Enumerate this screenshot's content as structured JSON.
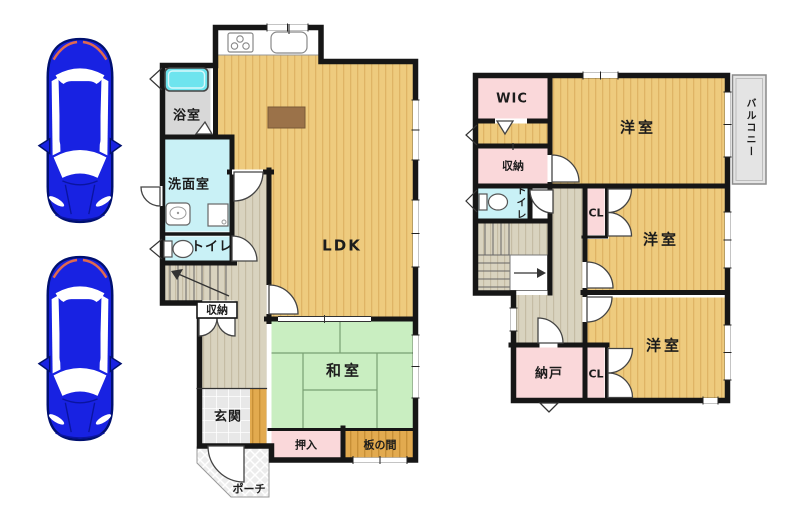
{
  "floor1": {
    "bath": "浴室",
    "washroom": "洗面室",
    "toilet": "トイレ",
    "ldk": "LDK",
    "storage": "収納",
    "genkan": "玄関",
    "washitsu": "和室",
    "oshiire": "押入",
    "itanoma": "板の間",
    "porch": "ポーチ"
  },
  "floor2": {
    "wic": "WIC",
    "bedroom1": "洋室",
    "bedroom2": "洋室",
    "bedroom3": "洋室",
    "storage": "収納",
    "toilet": "トイレ",
    "closet1": "CL",
    "closet2": "CL",
    "nando": "納戸",
    "balcony": "バルコニー"
  },
  "colors": {
    "wall": "#161616",
    "wood_floor": "#eecb7e",
    "wood_floor_stripe": "#dfb465",
    "hall_floor": "#d9d3bf",
    "hall_floor_stripe": "#c5bca4",
    "tatami": "#c9eec1",
    "tatami_line": "#79a073",
    "pink_room": "#fad8da",
    "cyan_room": "#c9f1f6",
    "bathtub": "#6ee4ee",
    "bath_floor": "#d8d8d8",
    "wood_dark": "#e2aa4f",
    "entrance_tile": "#e8e8e8",
    "balcony_gray": "#e4e4e4",
    "table_brown": "#9b7249",
    "car_blue": "#1822e2"
  }
}
